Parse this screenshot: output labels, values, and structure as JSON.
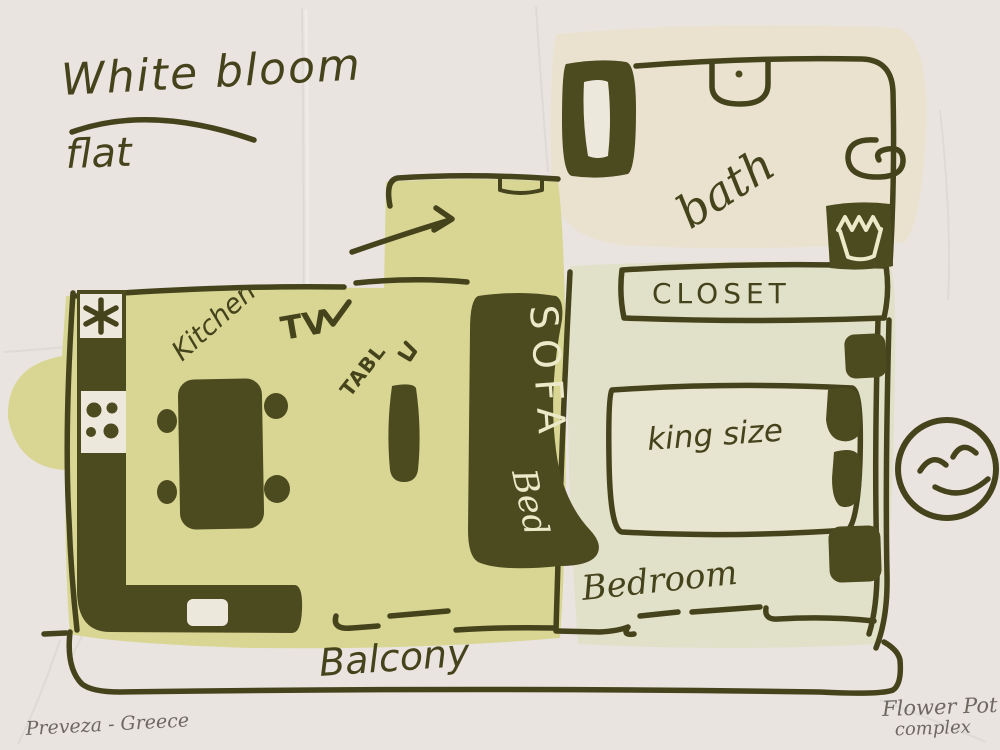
{
  "title": {
    "line1": "White bloom",
    "line2": "flat"
  },
  "rooms": {
    "bath": "bath",
    "closet": "CLOSET",
    "bedroom": "Bedroom",
    "king_bed": "king size",
    "kitchen": "Kitchen",
    "tv": "TV",
    "table": "TABL",
    "sofa_line1": "SOFA",
    "sofa_line2": "Bed",
    "balcony": "Balcony"
  },
  "footer": {
    "left": "Preveza - Greece",
    "right_line1": "Flower Pot",
    "right_line2": "complex"
  },
  "icons": {
    "entrance_arrow": "arrow-right",
    "tv_check": "checkmark",
    "stove_fan": "asterisk",
    "smiley": "happy-face"
  },
  "colors": {
    "paper": "#e9e4e0",
    "ink": "#45431c",
    "ink_fill": "#4c4a1f",
    "living_area": "#d9d694",
    "bath_area": "#eae2cf",
    "bedroom_area": "#e1e0c8",
    "sofa_text": "#ece9c9",
    "script_text": "#6e6861"
  }
}
